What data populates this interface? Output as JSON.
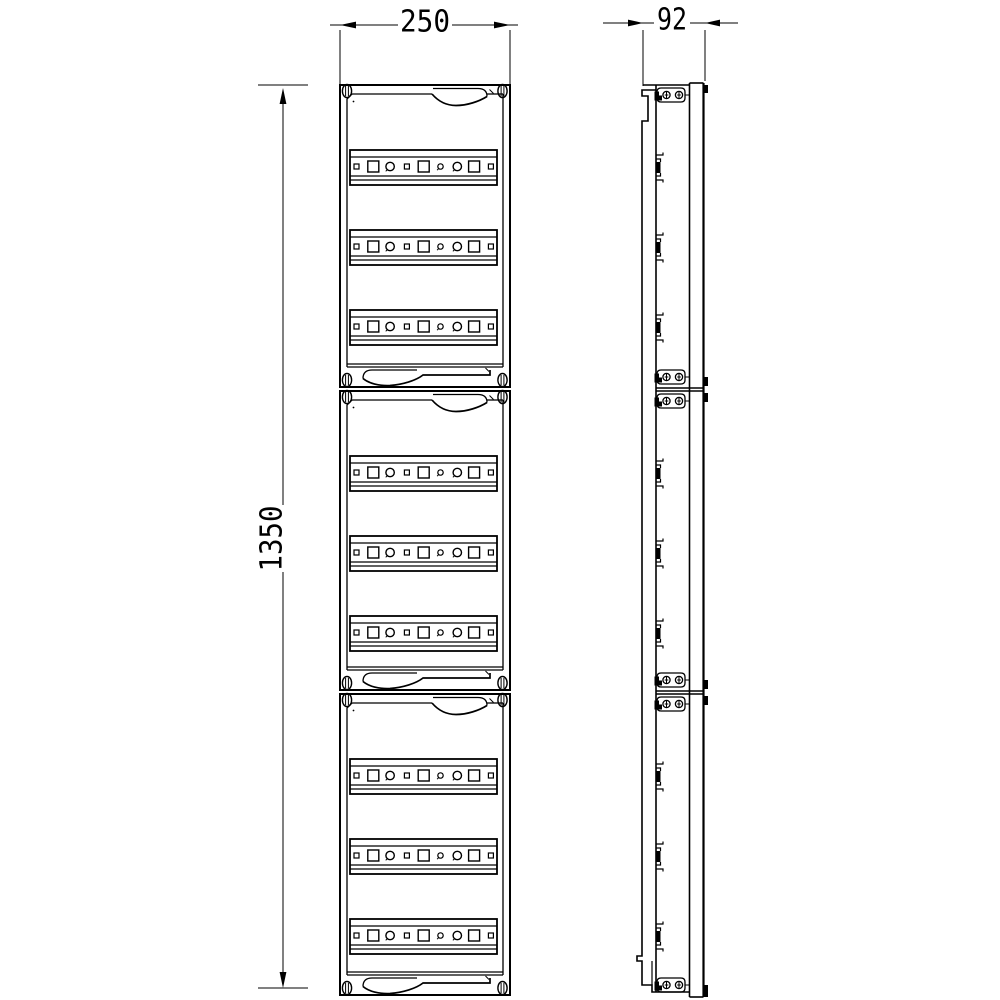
{
  "canvas": {
    "background": "#ffffff",
    "line_color": "#000000"
  },
  "dimensions": {
    "front_width": "250",
    "front_height": "1350",
    "side_depth": "92"
  },
  "front_view": {
    "module_count": 3,
    "rails_per_module": 3,
    "slots_per_rail": 9,
    "slot_pattern": [
      "square-small",
      "square-large",
      "circle",
      "square-small",
      "square-large",
      "circle-small",
      "circle",
      "square-large",
      "square-small"
    ],
    "corner_screws_per_module": 4,
    "handle_positions": {
      "top_strip": "right",
      "bottom_strip": "left"
    }
  },
  "side_view": {
    "rail_clip_count": 9,
    "bracket_count": 6,
    "junction_count": 2,
    "edge_tab_count": 6
  }
}
